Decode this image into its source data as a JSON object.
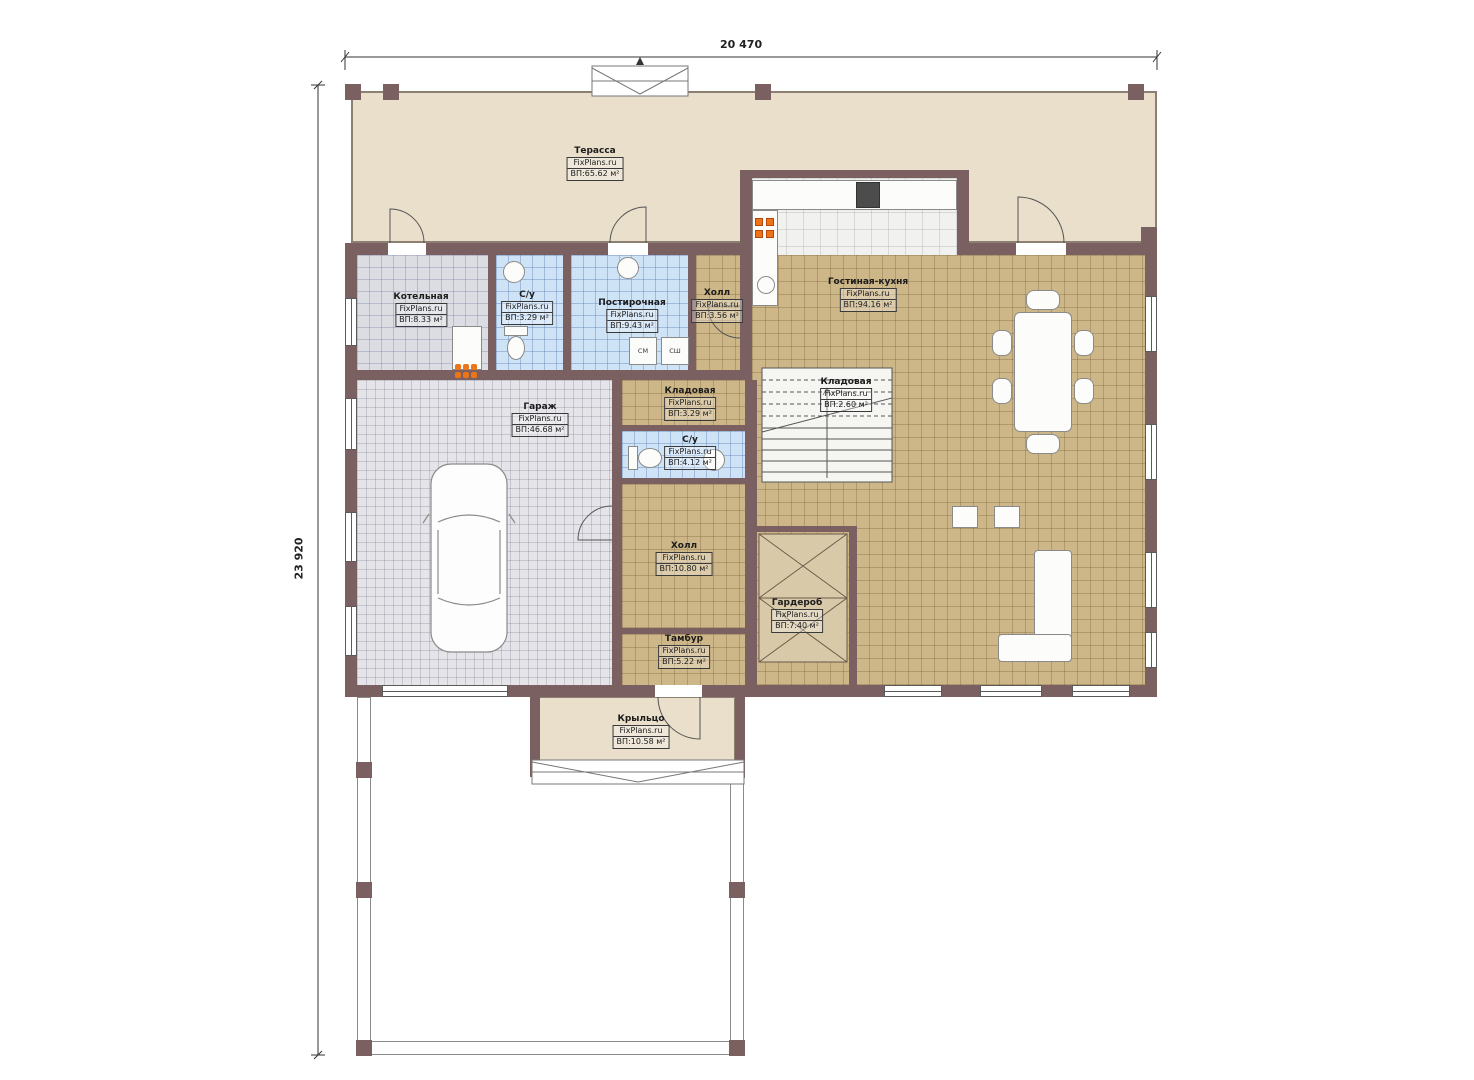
{
  "plan": {
    "dimension_top": "20 470",
    "dimension_left": "23 920",
    "watermark": "FixPlans.ru"
  },
  "rooms": [
    {
      "name": "Терасса",
      "area": "ВП:65.62 м²"
    },
    {
      "name": "Котельная",
      "area": "ВП:8.33 м²"
    },
    {
      "name": "С/у",
      "area": "ВП:3.29 м²"
    },
    {
      "name": "Постирочная",
      "area": "ВП:9.43 м²"
    },
    {
      "name": "Холл",
      "area": "ВП:3.56 м²"
    },
    {
      "name": "Гостиная-кухня",
      "area": "ВП:94.16 м²"
    },
    {
      "name": "Кладовая",
      "area": "ВП:3.29 м²"
    },
    {
      "name": "Кладовая",
      "area": "ВП:2.60 м²"
    },
    {
      "name": "С/у",
      "area": "ВП:4.12 м²"
    },
    {
      "name": "Гараж",
      "area": "ВП:46.68 м²"
    },
    {
      "name": "Холл",
      "area": "ВП:10.80 м²"
    },
    {
      "name": "Гардероб",
      "area": "ВП:7.40 м²"
    },
    {
      "name": "Тамбур",
      "area": "ВП:5.22 м²"
    },
    {
      "name": "Крыльцо",
      "area": "ВП:10.58 м²"
    }
  ],
  "appliances": {
    "washer": "СМ",
    "dryer": "СШ"
  },
  "colors": {
    "wall": "#7b6062",
    "terrace": "#e9dfca",
    "tan": "#cdb687",
    "blue": "#cfe3f6",
    "grayfloor": "#dcdde2",
    "garage": "#e4e4e9",
    "kitchen": "#f1f1ef",
    "burner": "#ee7418"
  }
}
